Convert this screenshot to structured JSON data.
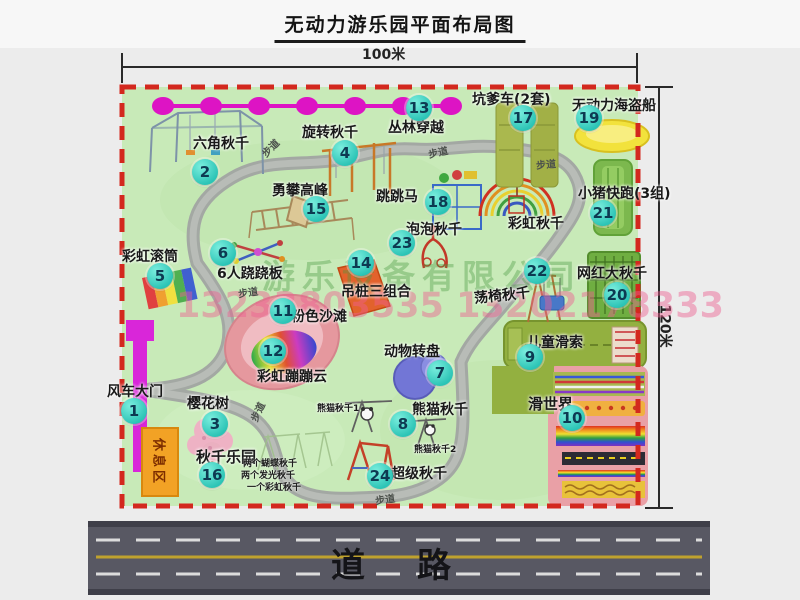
{
  "title": "无动力游乐园平面布局图",
  "dimensions": {
    "width_label": "100米",
    "height_label": "120米"
  },
  "walkway_label": "步道",
  "rest_area": {
    "label": "休息区"
  },
  "road": {
    "label": "道路"
  },
  "watermark": {
    "company": "游乐设备有限公司",
    "phone": "13233803535 13202178333"
  },
  "extra_labels": {
    "rainbow_swing": "彩虹秋千",
    "panda_swing_1": "熊猫秋千1",
    "panda_swing_2": "熊猫秋千2"
  },
  "attractions": [
    {
      "num": "1",
      "label": "风车大门"
    },
    {
      "num": "2",
      "label": "六角秋千"
    },
    {
      "num": "3",
      "label": "樱花树"
    },
    {
      "num": "4",
      "label": "旋转秋千"
    },
    {
      "num": "5",
      "label": "彩虹滚筒"
    },
    {
      "num": "6",
      "label": "6人跷跷板"
    },
    {
      "num": "7",
      "label": "动物转盘"
    },
    {
      "num": "8",
      "label": "熊猫秋千"
    },
    {
      "num": "9",
      "label": "儿童滑索"
    },
    {
      "num": "10",
      "label": "滑世界"
    },
    {
      "num": "11",
      "label": "粉色沙滩"
    },
    {
      "num": "12",
      "label": "彩虹蹦蹦云"
    },
    {
      "num": "13",
      "label": "丛林穿越"
    },
    {
      "num": "14",
      "label": "吊桩三组合"
    },
    {
      "num": "15",
      "label": "勇攀高峰"
    },
    {
      "num": "16",
      "label": "秋千乐园",
      "notes": [
        "两个蝴蝶秋千",
        "两个发光秋千",
        "一个彩虹秋千"
      ]
    },
    {
      "num": "17",
      "label": "坑爹车(2套)"
    },
    {
      "num": "18",
      "label": "跳跳马"
    },
    {
      "num": "19",
      "label": "无动力海盗船"
    },
    {
      "num": "20",
      "label": "网红大秋千"
    },
    {
      "num": "21",
      "label": "小猪快跑(3组)"
    },
    {
      "num": "22",
      "label": "荡椅秋千"
    },
    {
      "num": "23",
      "label": "泡泡秋千"
    },
    {
      "num": "24",
      "label": "超级秋千"
    }
  ],
  "colors": {
    "map_green": "#c8eab8",
    "marker_teal": "#2cc4b6",
    "border_red": "#d3281e",
    "zipline_magenta": "#dd14c4",
    "gate_magenta": "#d926d9",
    "rest_orange": "#f2a225",
    "road_gray": "#585863"
  }
}
